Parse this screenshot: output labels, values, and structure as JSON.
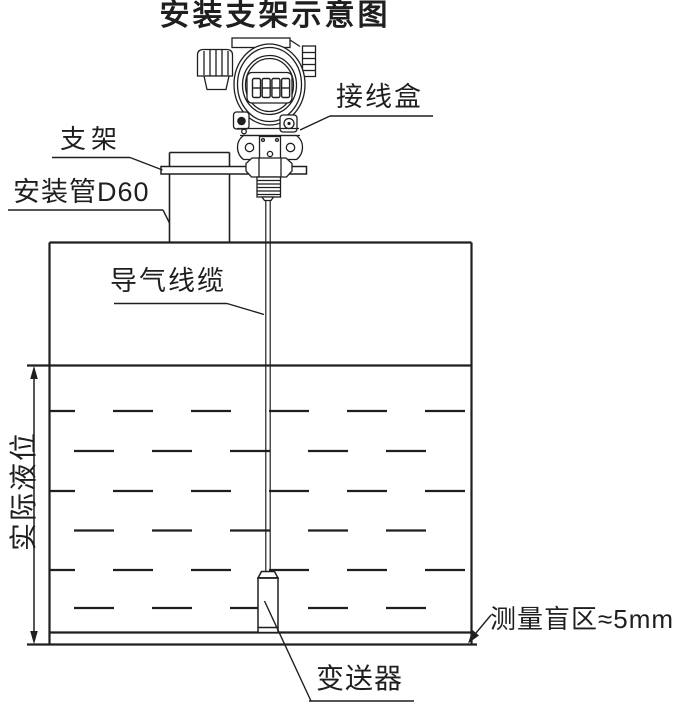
{
  "title": "安装支架示意图",
  "colors": {
    "line": "#1f1f1f",
    "background": "#ffffff"
  },
  "labels": {
    "junction_box": "接线盒",
    "bracket": "支架",
    "mounting_pipe": "安装管D60",
    "air_cable": "导气线缆",
    "actual_level": "实际液位",
    "blind_zone": "测量盲区≈5mm",
    "transmitter": "变送器"
  },
  "display": {
    "reading": "8888"
  }
}
